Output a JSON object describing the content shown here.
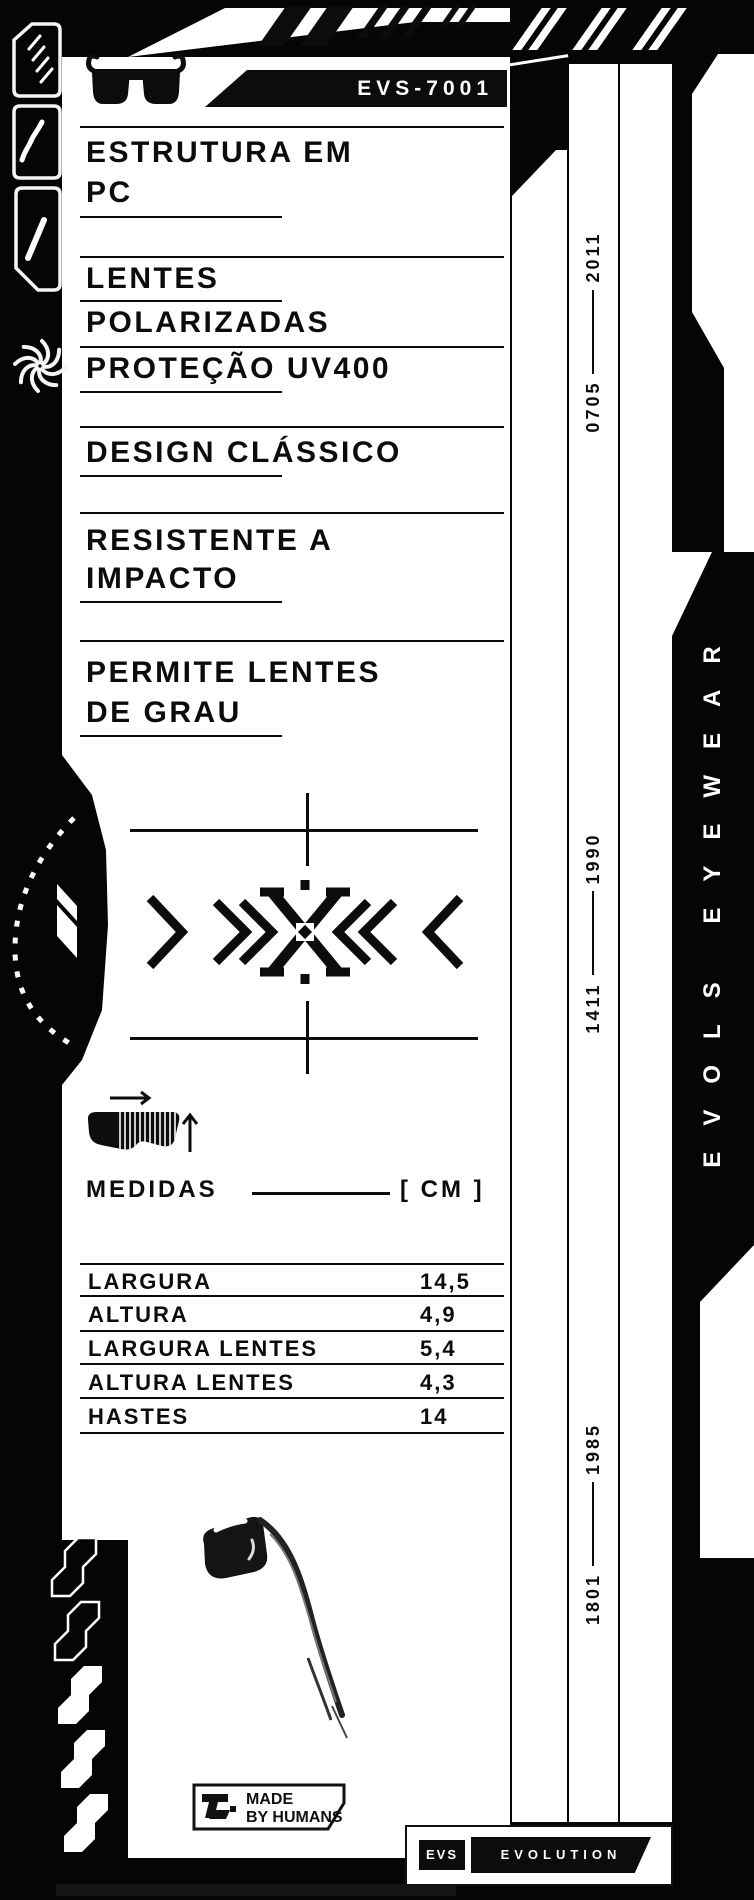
{
  "header": {
    "model": "EVS-7001"
  },
  "features": [
    {
      "lines": [
        "ESTRUTURA EM",
        "PC"
      ]
    },
    {
      "lines": [
        "LENTES",
        "POLARIZADAS"
      ]
    },
    {
      "lines": [
        "PROTEÇÃO UV400"
      ]
    },
    {
      "lines": [
        "DESIGN CLÁSSICO"
      ]
    },
    {
      "lines": [
        "RESISTENTE A",
        "IMPACTO"
      ]
    },
    {
      "lines": [
        "PERMITE LENTES",
        "DE GRAU"
      ]
    }
  ],
  "measures": {
    "title": "MEDIDAS",
    "unit": "[ CM ]",
    "rows": [
      {
        "label": "LARGURA",
        "value": "14,5"
      },
      {
        "label": "ALTURA",
        "value": "4,9"
      },
      {
        "label": "LARGURA LENTES",
        "value": "5,4"
      },
      {
        "label": "ALTURA LENTES",
        "value": "4,3"
      },
      {
        "label": "HASTES",
        "value": "14"
      }
    ]
  },
  "serials": [
    {
      "left": "0705",
      "right": "2011"
    },
    {
      "left": "1411",
      "right": "1990"
    },
    {
      "left": "1801",
      "right": "1985"
    }
  ],
  "branding": {
    "vertical": "EVOLS EYEWEAR",
    "made_line1": "MADE",
    "made_line2": "BY HUMANS",
    "badge_short": "EVS",
    "badge_long": "EVOLUTION"
  },
  "icons": {
    "sunglasses-icon": "black classic sunglasses silhouette",
    "goggles-measure-icon": "striped goggles with width and height arrows",
    "aperture-icon": "spinning shutter swirl",
    "hatch-icon": "four diagonal dashes",
    "curve-slash-icon": "curved diagonal stroke",
    "slash-icon": "single diagonal stroke",
    "x-emblem": "chevrons and cross emblem",
    "sketch": "hand-drawn sunglasses sketch"
  },
  "colors": {
    "paper": "#ffffff",
    "ink": "#0c0c0c",
    "bg": "#050505"
  }
}
